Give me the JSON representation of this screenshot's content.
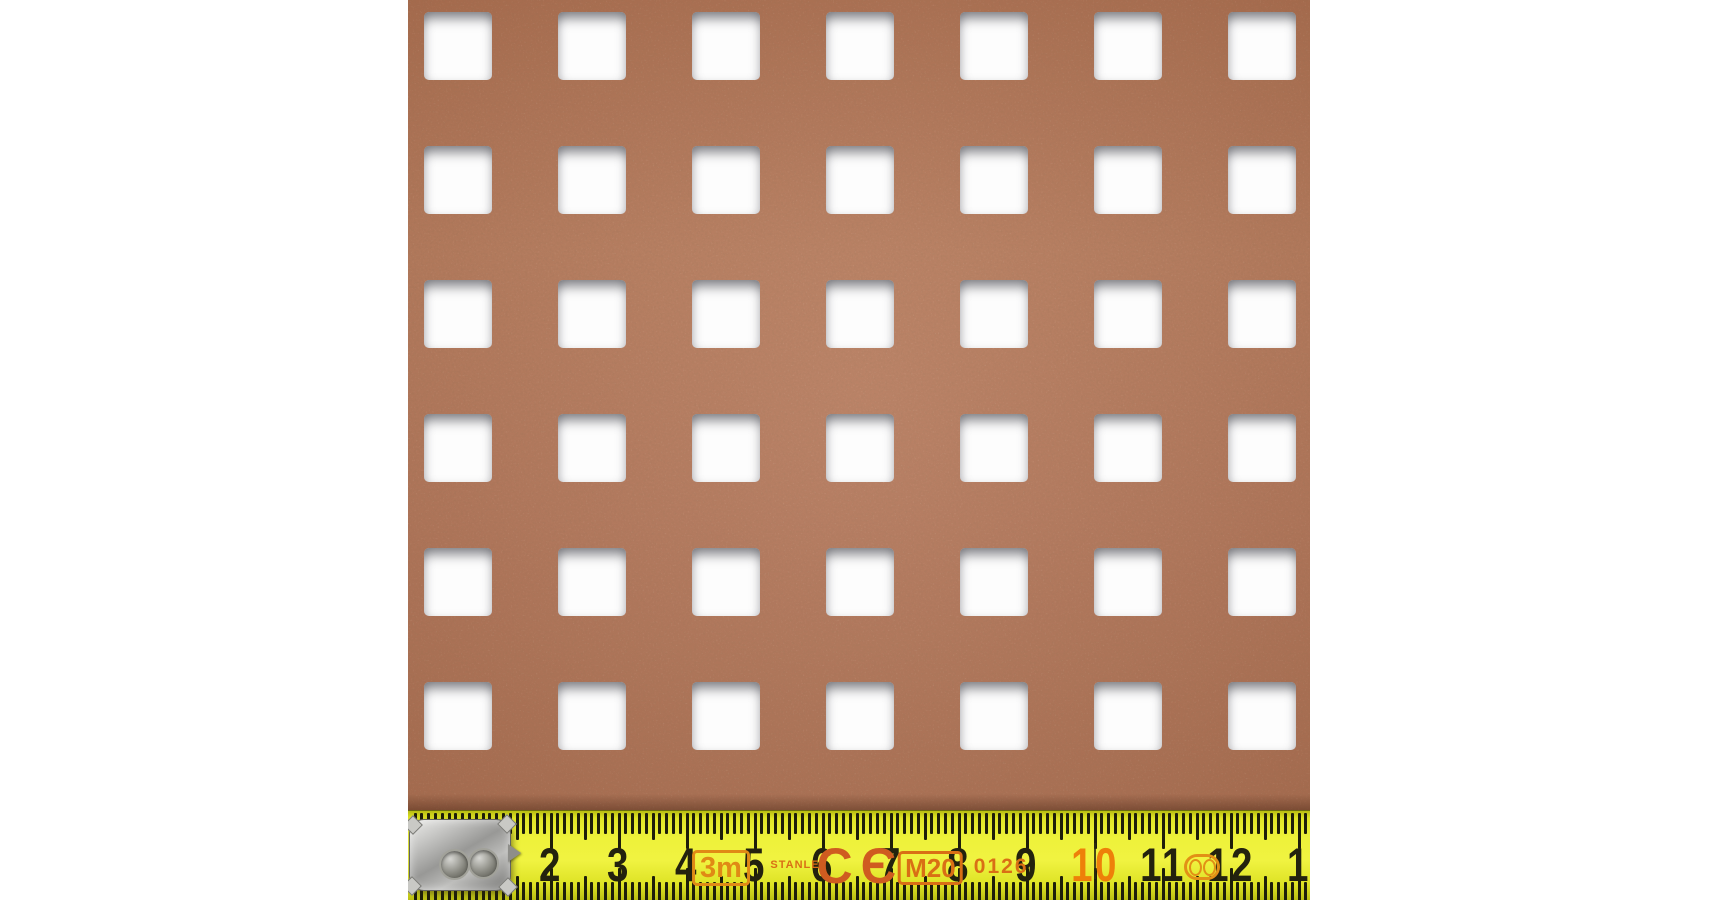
{
  "photo": {
    "background_color": "#ffffff",
    "sheet": {
      "label": "square-perforated-sheet",
      "base_color": "#b3775a",
      "hole_color": "#fdfdfd",
      "grid": {
        "cols": 7,
        "rows": 6,
        "hole_size": 68,
        "pitch": 134,
        "offset_x": 16,
        "offset_y": 12
      }
    },
    "ruler": {
      "unit": "cm",
      "cm_values": [
        2,
        3,
        4,
        5,
        6,
        7,
        8,
        9,
        10,
        11,
        12,
        13
      ],
      "cm_labels": [
        "2",
        "3",
        "4",
        "5",
        "6",
        "7",
        "8",
        "9",
        "10",
        "11",
        "12",
        "1"
      ],
      "highlight_value": 10,
      "markings": [
        {
          "id": "length-marking",
          "text": "3m",
          "cm": 4.5,
          "style": "boxed"
        },
        {
          "id": "brand-label",
          "text": "STANLEY",
          "cm": 5.65,
          "style": "small"
        },
        {
          "id": "ce-marking",
          "text": "CЄ",
          "cm": 6.55,
          "style": "ce"
        },
        {
          "id": "approval-marking",
          "text": "M20",
          "cm": 7.58,
          "style": "boxed2"
        },
        {
          "id": "notified-body-number",
          "text": "0126",
          "cm": 8.62,
          "style": "digits"
        },
        {
          "id": "joint-rings",
          "text": "",
          "cm": 11.58,
          "style": "rings"
        }
      ],
      "colors": {
        "yellow": "#eef23a",
        "tick": "#1e1e0a",
        "number": "#23220e",
        "highlight_number": "#ee8009",
        "accent_orange": "#d96f15"
      }
    }
  }
}
